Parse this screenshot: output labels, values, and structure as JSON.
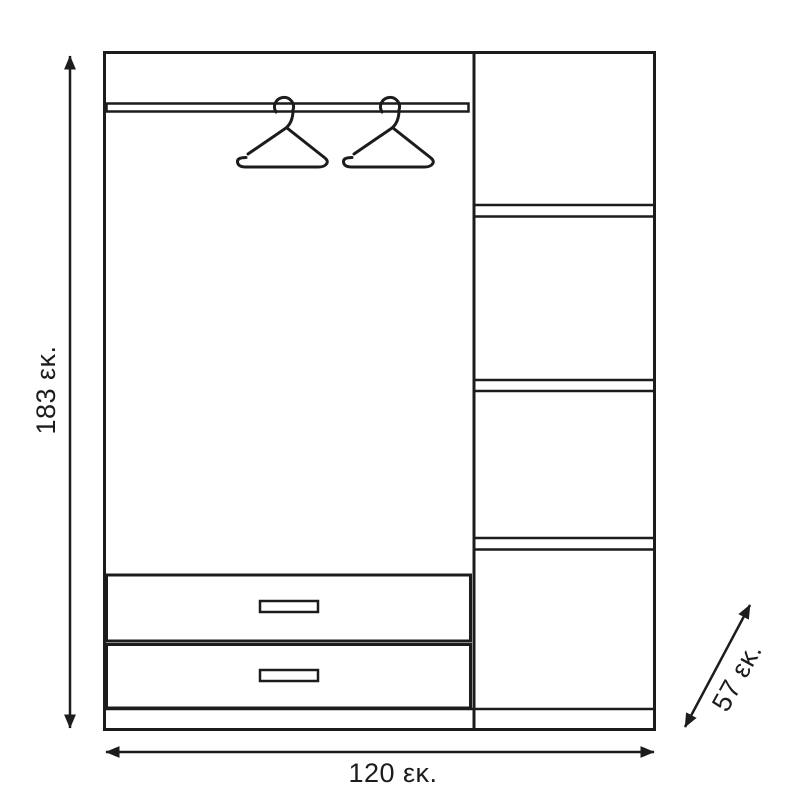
{
  "diagram": {
    "kind": "wardrobe technical dimension drawing",
    "unit": "εκ."
  },
  "dimensions": {
    "height": {
      "label": "183 εκ.",
      "value": 183,
      "unit": "εκ."
    },
    "width": {
      "label": "120 εκ.",
      "value": 120,
      "unit": "εκ."
    },
    "depth": {
      "label": "57 εκ.",
      "value": 57,
      "unit": "εκ."
    }
  },
  "features": {
    "hanger_count": 2,
    "drawer_count": 2,
    "right_column_compartments": 4
  },
  "icons": {
    "hanger": "hanger-icon",
    "dimension_arrow": "double-headed-arrow-icon"
  },
  "style": {
    "line_color": "#1c1c1c",
    "background": "#ffffff"
  }
}
